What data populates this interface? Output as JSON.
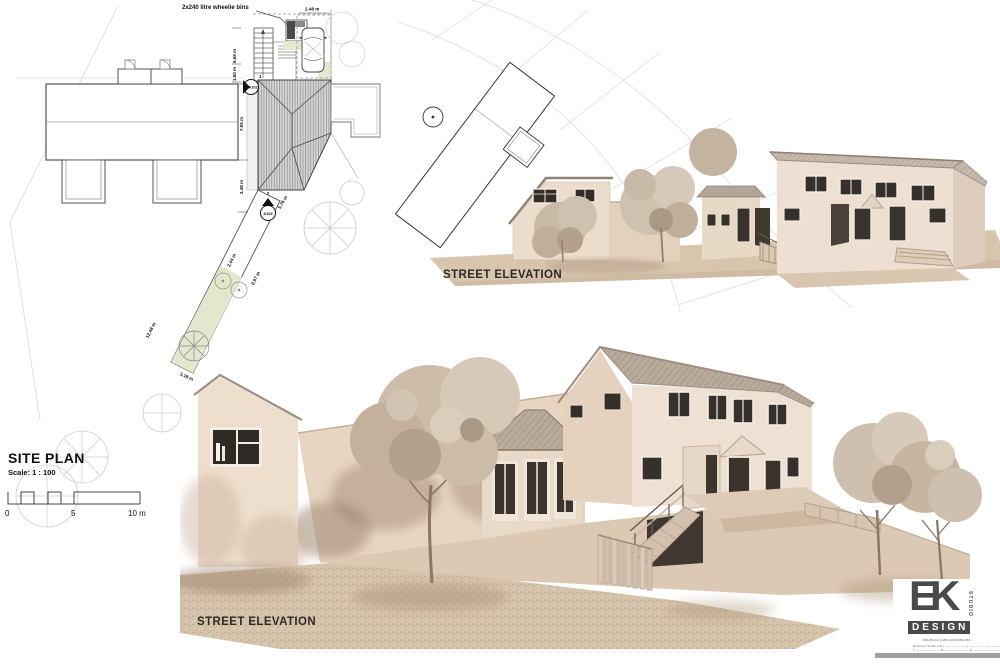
{
  "site_plan": {
    "title": "SITE PLAN",
    "scale_label": "Scale:  1 : 100",
    "scalebar": {
      "t0": "0",
      "t5": "5",
      "t10": "10 m"
    },
    "notes": {
      "bins": "2x240 litre wheelie bins"
    },
    "dims": {
      "car": "2.48 m",
      "stairs": "9.68 m",
      "entry": "1.60 m",
      "depth": "7.05 m",
      "rear": "3.48 m",
      "side": "5.76 m",
      "path_w": "2.44 m",
      "path_s": "0.97 m",
      "path_len": "12.48 m",
      "path_end": "3.18 m"
    },
    "markers": {
      "a1": "A102",
      "a2": "A102",
      "n1": "1",
      "n2": "2"
    }
  },
  "elevations": {
    "upper": {
      "label": "STREET ELEVATION"
    },
    "lower": {
      "label": "STREET ELEVATION"
    }
  },
  "logo": {
    "ek": "EK",
    "studio": "STUDIO",
    "design": "DESIGN",
    "tagline": "ARCHITECTURE & INTERIORS",
    "contact_1": "Ek Design Studio LTD  |  ————— ——  |  ——— ———  |  ——————",
    "contact_2": "T: ————————   M: ————————   E: ——————————   W: ——————————"
  },
  "colors": {
    "wall": "#ecdfd1",
    "wall_shade": "#d9c6b2",
    "roof": "#b7a99a",
    "ground": "#d8c5ae",
    "gravel": "#d4c1aa",
    "foliage": "#cbbcaa",
    "plan_green": "#e3e7cd",
    "line": "#555555"
  }
}
